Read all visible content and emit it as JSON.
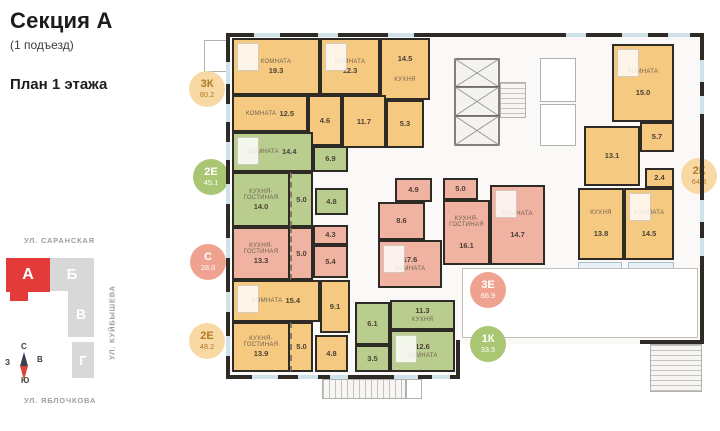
{
  "header": {
    "section_title": "Секция А",
    "entrance": "(1 подъезд)",
    "floor_title": "План 1 этажа"
  },
  "map": {
    "streets": {
      "top": "УЛ. САРАНСКАЯ",
      "right": "УЛ. КУЙБЫШЕВА",
      "bottom": "УЛ. ЯБЛОЧКОВА"
    },
    "blocks": [
      {
        "label": "А",
        "active": true
      },
      {
        "label": "Б",
        "active": false
      },
      {
        "label": "В",
        "active": false
      },
      {
        "label": "Г",
        "active": false
      }
    ],
    "compass": {
      "north": "С",
      "south": "Ю",
      "west": "З",
      "east": "В"
    }
  },
  "colors": {
    "room_orange": "#f6c981",
    "room_green": "#b9cd8e",
    "room_salmon": "#f0b2a1",
    "badge_orange_bg": "#f8d9a4",
    "badge_orange_text": "#b07a28",
    "badge_green_bg": "#a9c673",
    "badge_salmon_bg": "#efa28f",
    "badge_light_text": "#ffffff",
    "active_block_red": "#e23b3a",
    "wall": "#2e2b27",
    "window_glass": "#cfe2ea"
  },
  "apartments": [
    {
      "code": "3К",
      "total_area": "80.2",
      "palette": "orange",
      "badge": {
        "x": 207,
        "y": 89
      },
      "rooms": [
        {
          "label": "комната",
          "area": "19.3",
          "x": 232,
          "y": 38,
          "w": 88,
          "h": 57
        },
        {
          "label": "комната",
          "area": "12.5",
          "x": 232,
          "y": 95,
          "w": 76,
          "h": 37,
          "inline": true
        },
        {
          "label": "комната",
          "area": "12.3",
          "x": 320,
          "y": 38,
          "w": 60,
          "h": 57
        },
        {
          "label": "кухня",
          "area": "14.5",
          "x": 380,
          "y": 38,
          "w": 50,
          "h": 62,
          "label_after": true
        },
        {
          "area": "4.6",
          "x": 308,
          "y": 95,
          "w": 34,
          "h": 51
        },
        {
          "area": "11.7",
          "x": 342,
          "y": 95,
          "w": 44,
          "h": 53
        },
        {
          "area": "5.3",
          "x": 386,
          "y": 100,
          "w": 38,
          "h": 48
        }
      ]
    },
    {
      "code": "2Е",
      "total_area": "45.1",
      "palette": "green",
      "badge": {
        "x": 211,
        "y": 177
      },
      "halo": true,
      "rooms": [
        {
          "label": "комната",
          "area": "14.4",
          "x": 232,
          "y": 132,
          "w": 81,
          "h": 40,
          "inline": true
        },
        {
          "area": "6.9",
          "x": 313,
          "y": 146,
          "w": 35,
          "h": 26
        },
        {
          "label": "кухня-гостиная",
          "area": "14.0",
          "x": 232,
          "y": 172,
          "w": 58,
          "h": 55
        },
        {
          "area": "5.0",
          "x": 290,
          "y": 172,
          "w": 23,
          "h": 55,
          "zone": true
        },
        {
          "area": "4.8",
          "x": 315,
          "y": 188,
          "w": 33,
          "h": 27
        }
      ]
    },
    {
      "code": "С",
      "total_area": "28.0",
      "palette": "salmon",
      "badge": {
        "x": 208,
        "y": 262
      },
      "halo": true,
      "rooms": [
        {
          "label": "кухня-гостиная",
          "area": "13.3",
          "x": 232,
          "y": 227,
          "w": 58,
          "h": 53
        },
        {
          "area": "5.0",
          "x": 290,
          "y": 227,
          "w": 23,
          "h": 53,
          "zone": true
        },
        {
          "area": "4.3",
          "x": 313,
          "y": 225,
          "w": 35,
          "h": 20
        },
        {
          "area": "5.4",
          "x": 313,
          "y": 245,
          "w": 35,
          "h": 33
        }
      ]
    },
    {
      "code": "2Е",
      "total_area": "48.2",
      "palette": "orange",
      "badge": {
        "x": 207,
        "y": 341
      },
      "rooms": [
        {
          "label": "комната",
          "area": "15.4",
          "x": 232,
          "y": 280,
          "w": 88,
          "h": 42,
          "inline": true
        },
        {
          "area": "9.1",
          "x": 320,
          "y": 280,
          "w": 30,
          "h": 53
        },
        {
          "label": "кухня-гостиная",
          "area": "13.9",
          "x": 232,
          "y": 322,
          "w": 58,
          "h": 50
        },
        {
          "area": "5.0",
          "x": 290,
          "y": 322,
          "w": 23,
          "h": 50,
          "zone": true
        },
        {
          "area": "4.8",
          "x": 315,
          "y": 335,
          "w": 33,
          "h": 37
        }
      ]
    },
    {
      "code": "3Е",
      "total_area": "66.9",
      "palette": "salmon",
      "badge": {
        "x": 488,
        "y": 290
      },
      "rooms": [
        {
          "area": "4.9",
          "x": 395,
          "y": 178,
          "w": 37,
          "h": 24
        },
        {
          "area": "5.0",
          "x": 443,
          "y": 178,
          "w": 35,
          "h": 22
        },
        {
          "area": "8.6",
          "x": 378,
          "y": 202,
          "w": 47,
          "h": 38
        },
        {
          "label": "кухня-гостиная",
          "area": "16.1",
          "x": 443,
          "y": 200,
          "w": 47,
          "h": 65,
          "label_first": true
        },
        {
          "label": "комната",
          "area": "14.7",
          "x": 490,
          "y": 185,
          "w": 55,
          "h": 80,
          "label_first": true
        },
        {
          "label": "комната",
          "area": "17.6",
          "x": 378,
          "y": 240,
          "w": 64,
          "h": 48,
          "label_after": true
        }
      ]
    },
    {
      "code": "1К",
      "total_area": "33.5",
      "palette": "green",
      "badge": {
        "x": 488,
        "y": 344
      },
      "rooms": [
        {
          "area": "6.1",
          "x": 355,
          "y": 302,
          "w": 35,
          "h": 43
        },
        {
          "area": "3.5",
          "x": 355,
          "y": 345,
          "w": 35,
          "h": 27
        },
        {
          "label": "кухня",
          "area": "11.3",
          "x": 390,
          "y": 300,
          "w": 65,
          "h": 30,
          "label_after": true
        },
        {
          "label": "комната",
          "area": "12.6",
          "x": 390,
          "y": 330,
          "w": 65,
          "h": 42,
          "label_after": true
        }
      ]
    },
    {
      "code": "2К",
      "total_area": "64.5",
      "palette": "orange",
      "badge": {
        "x": 699,
        "y": 176
      },
      "rooms": [
        {
          "label": "комната",
          "area": "15.0",
          "x": 612,
          "y": 44,
          "w": 62,
          "h": 78,
          "label_first": true
        },
        {
          "area": "5.7",
          "x": 640,
          "y": 122,
          "w": 34,
          "h": 30
        },
        {
          "area": "13.1",
          "x": 584,
          "y": 126,
          "w": 56,
          "h": 60
        },
        {
          "area": "2.4",
          "x": 645,
          "y": 168,
          "w": 29,
          "h": 20
        },
        {
          "label": "кухня",
          "area": "13.8",
          "x": 578,
          "y": 188,
          "w": 46,
          "h": 72,
          "label_first": true
        },
        {
          "label": "комната",
          "area": "14.5",
          "x": 624,
          "y": 188,
          "w": 50,
          "h": 72,
          "label_first": true
        }
      ]
    }
  ]
}
